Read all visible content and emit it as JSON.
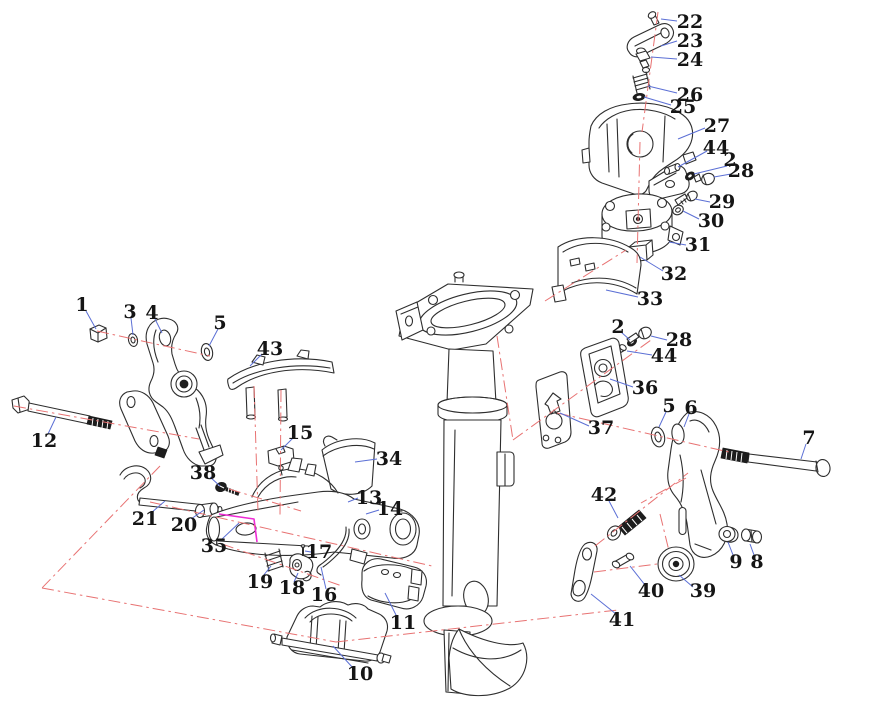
{
  "diagram": {
    "kind": "exploded-parts-diagram",
    "colors": {
      "label": "#151515",
      "leader": "#5b6fd5",
      "centerline": "#e87272",
      "highlight": "#ee2bd4",
      "line": "#2e2e2e",
      "background": "#ffffff"
    },
    "callouts": [
      {
        "label": "22",
        "tx": 690,
        "ty": 22,
        "x1": 677,
        "y1": 21,
        "x2": 661,
        "y2": 19
      },
      {
        "label": "23",
        "tx": 690,
        "ty": 41,
        "x1": 677,
        "y1": 41,
        "x2": 661,
        "y2": 46
      },
      {
        "label": "24",
        "tx": 690,
        "ty": 60,
        "x1": 677,
        "y1": 59,
        "x2": 651,
        "y2": 57
      },
      {
        "label": "26",
        "tx": 690,
        "ty": 95,
        "x1": 677,
        "y1": 93,
        "x2": 648,
        "y2": 86
      },
      {
        "label": "25",
        "tx": 683,
        "ty": 107,
        "x1": 671,
        "y1": 105,
        "x2": 644,
        "y2": 97
      },
      {
        "label": "27",
        "tx": 717,
        "ty": 126,
        "x1": 705,
        "y1": 128,
        "x2": 678,
        "y2": 139
      },
      {
        "label": "44",
        "tx": 716,
        "ty": 148,
        "x1": 707,
        "y1": 151,
        "x2": 678,
        "y2": 167
      },
      {
        "label": "2",
        "tx": 730,
        "ty": 160,
        "x1": 727,
        "y1": 166,
        "x2": 694,
        "y2": 174
      },
      {
        "label": "28",
        "tx": 741,
        "ty": 171,
        "x1": 731,
        "y1": 174,
        "x2": 714,
        "y2": 177
      },
      {
        "label": "29",
        "tx": 722,
        "ty": 202,
        "x1": 710,
        "y1": 202,
        "x2": 695,
        "y2": 199
      },
      {
        "label": "30",
        "tx": 711,
        "ty": 221,
        "x1": 699,
        "y1": 219,
        "x2": 683,
        "y2": 211
      },
      {
        "label": "31",
        "tx": 698,
        "ty": 245,
        "x1": 686,
        "y1": 245,
        "x2": 669,
        "y2": 242
      },
      {
        "label": "32",
        "tx": 674,
        "ty": 274,
        "x1": 663,
        "y1": 271,
        "x2": 640,
        "y2": 257
      },
      {
        "label": "33",
        "tx": 650,
        "ty": 299,
        "x1": 638,
        "y1": 297,
        "x2": 606,
        "y2": 290
      },
      {
        "label": "2",
        "tx": 618,
        "ty": 327,
        "x1": 621,
        "y1": 332,
        "x2": 630,
        "y2": 340
      },
      {
        "label": "28",
        "tx": 679,
        "ty": 340,
        "x1": 667,
        "y1": 340,
        "x2": 651,
        "y2": 336
      },
      {
        "label": "44",
        "tx": 664,
        "ty": 356,
        "x1": 652,
        "y1": 355,
        "x2": 627,
        "y2": 351
      },
      {
        "label": "36",
        "tx": 645,
        "ty": 388,
        "x1": 633,
        "y1": 387,
        "x2": 610,
        "y2": 379
      },
      {
        "label": "37",
        "tx": 601,
        "ty": 428,
        "x1": 589,
        "y1": 426,
        "x2": 560,
        "y2": 413
      },
      {
        "label": "5",
        "tx": 669,
        "ty": 406,
        "x1": 666,
        "y1": 412,
        "x2": 659,
        "y2": 427
      },
      {
        "label": "6",
        "tx": 691,
        "ty": 408,
        "x1": 689,
        "y1": 414,
        "x2": 684,
        "y2": 427
      },
      {
        "label": "7",
        "tx": 809,
        "ty": 438,
        "x1": 806,
        "y1": 444,
        "x2": 801,
        "y2": 459
      },
      {
        "label": "9",
        "tx": 736,
        "ty": 562,
        "x1": 733,
        "y1": 555,
        "x2": 728,
        "y2": 542
      },
      {
        "label": "8",
        "tx": 757,
        "ty": 562,
        "x1": 754,
        "y1": 555,
        "x2": 750,
        "y2": 544
      },
      {
        "label": "39",
        "tx": 703,
        "ty": 591,
        "x1": 693,
        "y1": 587,
        "x2": 679,
        "y2": 575
      },
      {
        "label": "40",
        "tx": 651,
        "ty": 591,
        "x1": 645,
        "y1": 585,
        "x2": 630,
        "y2": 566
      },
      {
        "label": "41",
        "tx": 622,
        "ty": 620,
        "x1": 616,
        "y1": 614,
        "x2": 591,
        "y2": 594
      },
      {
        "label": "42",
        "tx": 604,
        "ty": 495,
        "x1": 609,
        "y1": 501,
        "x2": 618,
        "y2": 518
      },
      {
        "label": "1",
        "tx": 82,
        "ty": 305,
        "x1": 86,
        "y1": 311,
        "x2": 96,
        "y2": 329
      },
      {
        "label": "3",
        "tx": 130,
        "ty": 312,
        "x1": 131,
        "y1": 318,
        "x2": 133,
        "y2": 335
      },
      {
        "label": "4",
        "tx": 152,
        "ty": 313,
        "x1": 155,
        "y1": 319,
        "x2": 162,
        "y2": 333
      },
      {
        "label": "5",
        "tx": 220,
        "ty": 323,
        "x1": 218,
        "y1": 329,
        "x2": 209,
        "y2": 346
      },
      {
        "label": "12",
        "tx": 44,
        "ty": 441,
        "x1": 48,
        "y1": 434,
        "x2": 56,
        "y2": 417
      },
      {
        "label": "43",
        "tx": 270,
        "ty": 349,
        "x1": 262,
        "y1": 354,
        "x2": 250,
        "y2": 366
      },
      {
        "label": "15",
        "tx": 300,
        "ty": 433,
        "x1": 293,
        "y1": 438,
        "x2": 281,
        "y2": 450
      },
      {
        "label": "34",
        "tx": 389,
        "ty": 459,
        "x1": 377,
        "y1": 459,
        "x2": 355,
        "y2": 462
      },
      {
        "label": "13",
        "tx": 369,
        "ty": 498,
        "x1": 358,
        "y1": 498,
        "x2": 348,
        "y2": 502
      },
      {
        "label": "14",
        "tx": 390,
        "ty": 509,
        "x1": 379,
        "y1": 510,
        "x2": 366,
        "y2": 514
      },
      {
        "label": "38",
        "tx": 203,
        "ty": 473,
        "x1": 210,
        "y1": 477,
        "x2": 220,
        "y2": 486
      },
      {
        "label": "21",
        "tx": 145,
        "ty": 519,
        "x1": 151,
        "y1": 513,
        "x2": 165,
        "y2": 501
      },
      {
        "label": "20",
        "tx": 184,
        "ty": 525,
        "x1": 191,
        "y1": 519,
        "x2": 204,
        "y2": 510
      },
      {
        "label": "35",
        "tx": 214,
        "ty": 546,
        "x1": 221,
        "y1": 540,
        "x2": 239,
        "y2": 523
      },
      {
        "label": "17",
        "tx": 319,
        "ty": 552,
        "x1": 311,
        "y1": 552,
        "x2": 305,
        "y2": 551
      },
      {
        "label": "19",
        "tx": 260,
        "ty": 582,
        "x1": 263,
        "y1": 576,
        "x2": 271,
        "y2": 566
      },
      {
        "label": "18",
        "tx": 292,
        "ty": 588,
        "x1": 294,
        "y1": 582,
        "x2": 298,
        "y2": 573
      },
      {
        "label": "16",
        "tx": 324,
        "ty": 595,
        "x1": 326,
        "y1": 589,
        "x2": 321,
        "y2": 567
      },
      {
        "label": "11",
        "tx": 403,
        "ty": 623,
        "x1": 397,
        "y1": 617,
        "x2": 385,
        "y2": 593
      },
      {
        "label": "10",
        "tx": 360,
        "ty": 674,
        "x1": 353,
        "y1": 668,
        "x2": 333,
        "y2": 646
      }
    ]
  }
}
